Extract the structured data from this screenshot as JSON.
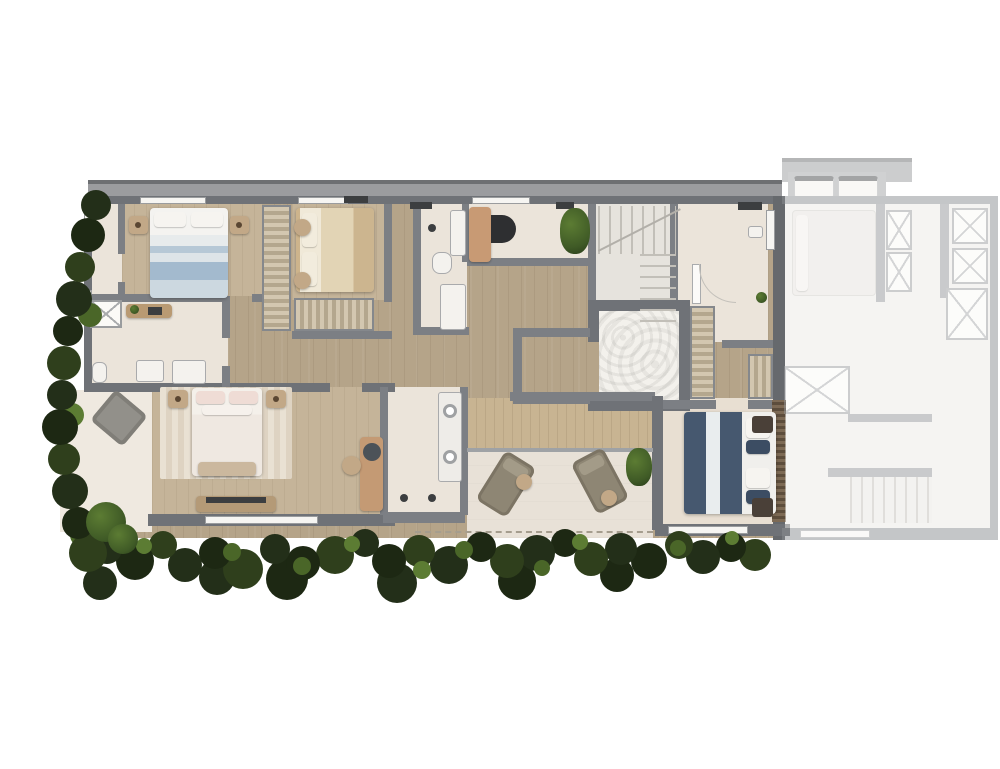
{
  "meta": {
    "type": "architectural floor plan",
    "style": "top-down furnished 3D render of an upper floor unit with terrace and garden hedge",
    "visible_text": "none (only illegible millimetric dimension marks on walls)"
  },
  "palette": {
    "wall": "#6f7277",
    "wallInner": "#7c7f84",
    "roof": "#9b9c9f",
    "wood": "#b5a489",
    "woodRoom": "#c5b499",
    "deck": "#c8b492",
    "cream": "#ebe4da",
    "terrace": "#e8e1d7",
    "vegDark": "#232f19",
    "vegMid": "#35471f",
    "vegLight": "#5c7c33",
    "bedBlue": "#9fb6c8",
    "bedBeige": "#ddd0b4",
    "bedBlush": "#e0cbc3",
    "bedNavy": "#46586f",
    "furnitureTan": "#c8a87e",
    "furnitureGray": "#8e8b82"
  },
  "legend": {
    "main_unit_rooms": [
      "bedroom-1 (double bed, blue striped bedding, top-left)",
      "ensuite-bathroom-left (shower box, toilet, twin basins)",
      "bedroom-2 (beige bedding, wardrobes)",
      "bathroom-top (vanity, toilet, counter)",
      "study-nook (desk, chair, plant)",
      "staircase (switchback flights)",
      "utility-room (door leaf, window, appliance)",
      "central-shower-room (textured floor, walk-in vestibule)",
      "master-bedroom (pink striped bed, vanity desk, TV sideboard)",
      "master-bathroom (double round-sink vanity)",
      "bedroom-3 (navy bedding, dark nightstands, slatted wardrobe)",
      "balcony-left (grey armchair)",
      "terrace (two loungers, side tables, glass railing, dashed roof-overhang line)"
    ],
    "neighbor_unit": "adjacent mirrored unit rendered faded/ghosted with bed, X-marked closets, two AC condensers on roof ledge and a staircase",
    "landscape": "dark green hedge band along left edge and bottom of the plan"
  }
}
